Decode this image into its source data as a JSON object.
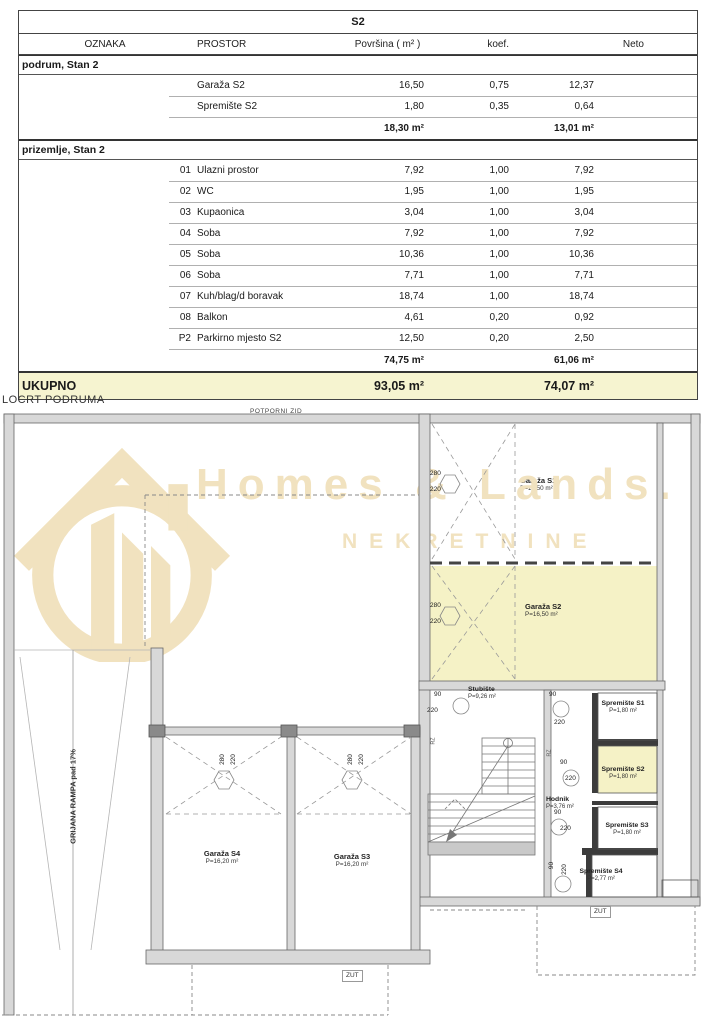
{
  "table": {
    "title": "S2",
    "columns": [
      "OZNAKA",
      "PROSTOR",
      "Površina ( m² )",
      "koef.",
      "Neto"
    ],
    "sections": [
      {
        "header": "podrum, Stan 2",
        "rows": [
          {
            "oznaka": "",
            "prostor": "Garaža S2",
            "povrsina": "16,50",
            "koef": "0,75",
            "neto": "12,37"
          },
          {
            "oznaka": "",
            "prostor": "Spremište S2",
            "povrsina": "1,80",
            "koef": "0,35",
            "neto": "0,64"
          }
        ],
        "subtotal": {
          "povrsina": "18,30 m²",
          "neto": "13,01 m²"
        }
      },
      {
        "header": "prizemlje, Stan 2",
        "rows": [
          {
            "oznaka": "01",
            "prostor": "Ulazni prostor",
            "povrsina": "7,92",
            "koef": "1,00",
            "neto": "7,92"
          },
          {
            "oznaka": "02",
            "prostor": "WC",
            "povrsina": "1,95",
            "koef": "1,00",
            "neto": "1,95"
          },
          {
            "oznaka": "03",
            "prostor": "Kupaonica",
            "povrsina": "3,04",
            "koef": "1,00",
            "neto": "3,04"
          },
          {
            "oznaka": "04",
            "prostor": "Soba",
            "povrsina": "7,92",
            "koef": "1,00",
            "neto": "7,92"
          },
          {
            "oznaka": "05",
            "prostor": "Soba",
            "povrsina": "10,36",
            "koef": "1,00",
            "neto": "10,36"
          },
          {
            "oznaka": "06",
            "prostor": "Soba",
            "povrsina": "7,71",
            "koef": "1,00",
            "neto": "7,71"
          },
          {
            "oznaka": "07",
            "prostor": "Kuh/blag/d boravak",
            "povrsina": "18,74",
            "koef": "1,00",
            "neto": "18,74"
          },
          {
            "oznaka": "08",
            "prostor": "Balkon",
            "povrsina": "4,61",
            "koef": "0,20",
            "neto": "0,92"
          },
          {
            "oznaka": "P2",
            "prostor": "Parkirno mjesto S2",
            "povrsina": "12,50",
            "koef": "0,20",
            "neto": "2,50"
          }
        ],
        "subtotal": {
          "povrsina": "74,75 m²",
          "neto": "61,06 m²"
        }
      }
    ],
    "total": {
      "label": "UKUPNO",
      "povrsina": "93,05 m²",
      "neto": "74,07 m²"
    }
  },
  "plan": {
    "title": "LOCRT PODRUMA",
    "wall_label": "POTPORNI ZID",
    "ramp_label": "GRIJANA RAMPA pad 17%",
    "zut_label": "ZUT",
    "rz_label": "RZ",
    "rooms": {
      "garaza_s1": {
        "name": "Garaža S1",
        "area": "P=16,50 m²"
      },
      "garaza_s2": {
        "name": "Garaža S2",
        "area": "P=16,50 m²"
      },
      "garaza_s3": {
        "name": "Garaža S3",
        "area": "P=16,20 m²"
      },
      "garaza_s4": {
        "name": "Garaža S4",
        "area": "P=16,20 m²"
      },
      "stubiste": {
        "name": "Stubište",
        "area": "P=9,26 m²"
      },
      "spremiste_s1": {
        "name": "Spremište S1",
        "area": "P=1,80 m²"
      },
      "spremiste_s2": {
        "name": "Spremište S2",
        "area": "P=1,80 m²"
      },
      "spremiste_s3": {
        "name": "Spremište S3",
        "area": "P=1,80 m²"
      },
      "spremiste_s4": {
        "name": "Spremište S4",
        "area": "P=2,77 m²"
      },
      "hodnik": {
        "name": "Hodnik",
        "area": "P=3,76 m²"
      }
    },
    "dims": {
      "d280": "280",
      "d220": "220",
      "d90": "90"
    }
  },
  "watermark": {
    "title": "Homes & Lands.",
    "subtitle": "NEKRETNINE"
  },
  "colors": {
    "total_row_yellow": "#f6f4d0",
    "room_highlight_yellow": "#f5f2c6",
    "watermark_beige": "#f1e2bf",
    "wall_gray": "#d8d8d8",
    "line_dark": "#555555"
  }
}
